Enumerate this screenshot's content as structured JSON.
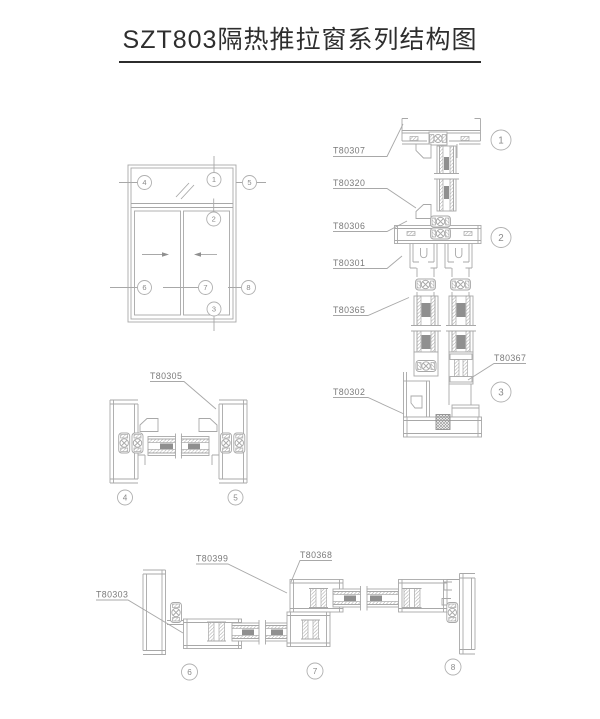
{
  "title": "SZT803隔热推拉窗系列结构图",
  "colors": {
    "line": "#a8a8a8",
    "label_text": "#7a7a7a",
    "title_text": "#2e2e2e",
    "glass_spacer_block": "#8f8f8f",
    "hatch": "#bcbcbc",
    "marker_circle": "#b0b0b0"
  },
  "markers": {
    "m1": "1",
    "m2": "2",
    "m3": "3",
    "m4": "4",
    "m5": "5",
    "m6": "6",
    "m7": "7",
    "m8": "8"
  },
  "part_labels": {
    "t80307": "T80307",
    "t80320": "T80320",
    "t80306": "T80306",
    "t80301": "T80301",
    "t80365": "T80365",
    "t80367": "T80367",
    "t80302": "T80302",
    "t80305": "T80305",
    "t80303": "T80303",
    "t80399": "T80399",
    "t80368": "T80368"
  }
}
